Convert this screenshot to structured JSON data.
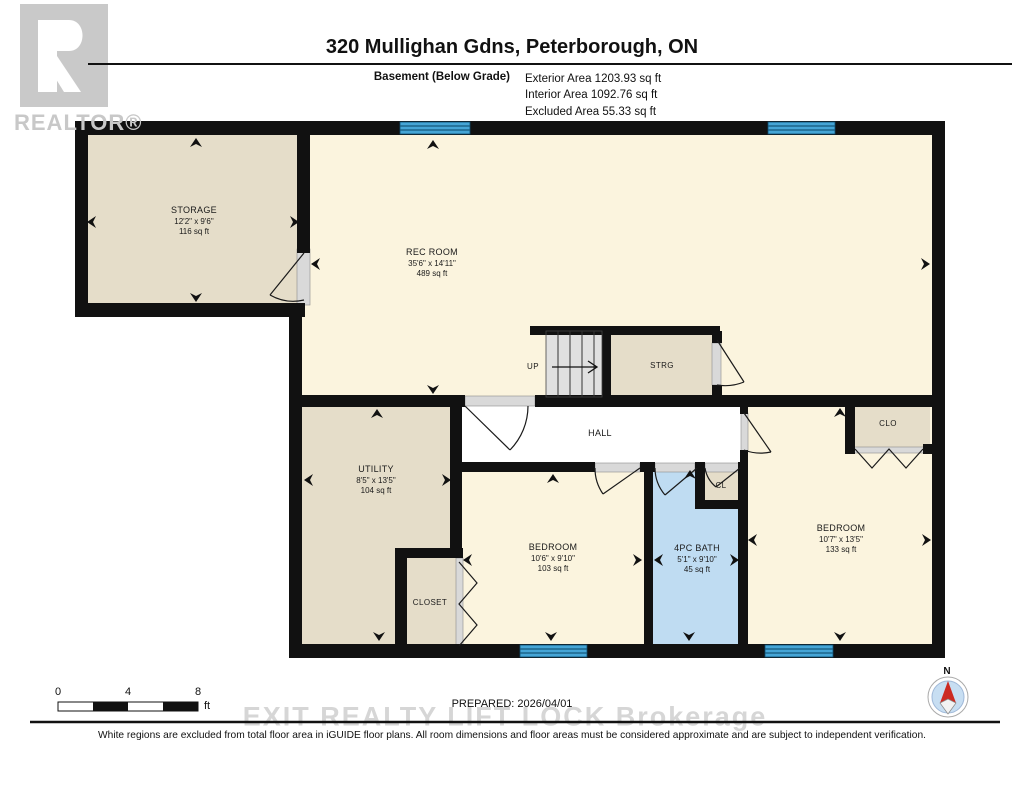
{
  "header": {
    "title": "320 Mullighan Gdns, Peterborough, ON",
    "floor_label": "Basement (Below Grade)",
    "exterior_area": "Exterior Area 1203.93 sq ft",
    "interior_area": "Interior Area 1092.76 sq ft",
    "excluded_area": "Excluded Area 55.33 sq ft"
  },
  "branding": {
    "realtor_logo_letter": "R",
    "realtor_label": "REALTOR®",
    "brokerage_watermark": "EXIT REALTY LIFT LOCK Brokerage"
  },
  "rooms": {
    "storage": {
      "name": "STORAGE",
      "dims": "12'2\" x 9'6\"",
      "area": "116 sq ft"
    },
    "rec_room": {
      "name": "REC ROOM",
      "dims": "35'6\" x 14'11\"",
      "area": "489 sq ft"
    },
    "stairs": {
      "label": "UP"
    },
    "strg": {
      "name": "STRG"
    },
    "hall": {
      "name": "HALL"
    },
    "utility": {
      "name": "UTILITY",
      "dims": "8'5\" x 13'5\"",
      "area": "104 sq ft"
    },
    "closet": {
      "name": "CLOSET"
    },
    "bedroom_mid": {
      "name": "BEDROOM",
      "dims": "10'6\" x 9'10\"",
      "area": "103 sq ft"
    },
    "bath": {
      "name": "4PC BATH",
      "dims": "5'1\" x 9'10\"",
      "area": "45 sq ft"
    },
    "cl": {
      "name": "CL"
    },
    "bedroom_right": {
      "name": "BEDROOM",
      "dims": "10'7\" x 13'5\"",
      "area": "133 sq ft"
    },
    "clo": {
      "name": "CLO"
    }
  },
  "footer": {
    "prepared": "PREPARED: 2026/04/01",
    "disclaimer": "White regions are excluded from total floor area in iGUIDE floor plans. All room dimensions and floor areas must be considered approximate and are subject to independent verification.",
    "scale_tick_0": "0",
    "scale_tick_4": "4",
    "scale_tick_8": "8",
    "scale_unit": "ft",
    "compass_north": "N"
  },
  "colors": {
    "wall": "#111111",
    "room_cream": "#FBF4DE",
    "room_tan": "#E5DDC9",
    "bath_blue": "#BFDCF2",
    "window_blue": "#45A5D6",
    "stair_gray": "#E0E0E0",
    "hall_white": "#FFFFFF",
    "watermark_gray": "#D6D6D6",
    "compass_red": "#CC2A22"
  }
}
